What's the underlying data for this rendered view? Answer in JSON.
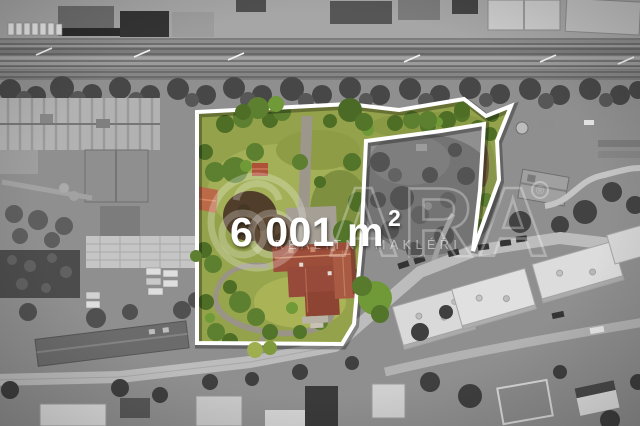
{
  "overlay": {
    "area_value": "6 001 m",
    "area_superscript": "2",
    "boundary_color": "#ffffff"
  },
  "watermark": {
    "brand": "ARA",
    "registered_mark": "®",
    "tagline": "REALITNÍ MAKLÉŘI"
  },
  "palette": {
    "lawn": "#94a24b",
    "lawn_light": "#aab457",
    "tree_dark": "#4a6a25",
    "tree_mid": "#5d8030",
    "roof_terracotta": "#9d4e3a",
    "roof_orange": "#bb6a48",
    "gray_base": "#8f8f8f",
    "road_gray": "#bdbdbd"
  }
}
